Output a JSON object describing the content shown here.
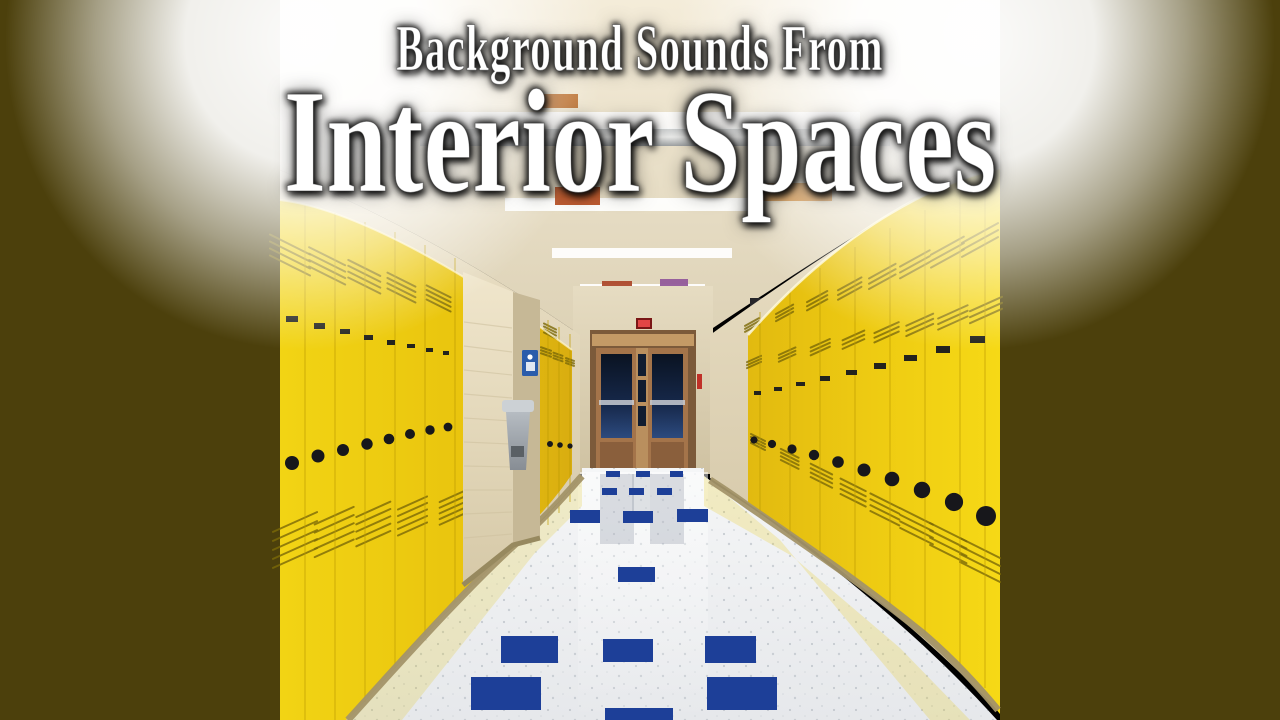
{
  "page": {
    "type": "album-art-thumbnail",
    "description": "School hallway with bright yellow lockers on both sides, cream block walls, white terrazzo floor with navy blue accent tiles, double doors with dark windows at the far end, fluorescent ceiling lights and posters on the ceiling. Dark olive pillarbox bars left and right. White serif title text with dark glow."
  },
  "titles": {
    "line1": "Background Sounds From",
    "line2": "Interior Spaces"
  },
  "colors": {
    "letterbox": "#4c400c",
    "locker_yellow": "#efc90e",
    "ceiling": "#eee6d0",
    "far_wall": "#d9cdae",
    "floor": "#eff1f3",
    "floor_tile": "#1d3f98",
    "door_frame": "#a4744a",
    "door_glass": "#16243e",
    "exit_sign": "#e24545",
    "restroom_sign": "#2a5cab",
    "trim": "#a39468",
    "text": "#ffffff"
  },
  "scene_items": {
    "ceiling_lights": {
      "type": "rect",
      "fill": "#ffffff",
      "opacity": 0.92,
      "items": [
        [
          140,
          112,
          440,
          17
        ],
        [
          225,
          198,
          255,
          13
        ],
        [
          272,
          248,
          180,
          10
        ],
        [
          300,
          284,
          125,
          8
        ],
        [
          318,
          306,
          88,
          6
        ]
      ]
    },
    "posters": {
      "type": "rect",
      "opacity": 0.95,
      "items": [
        [
          275,
          187,
          45,
          18,
          "#b85226"
        ],
        [
          478,
          183,
          74,
          18,
          "#c8812e"
        ],
        [
          322,
          281,
          30,
          12,
          "#ad4a2c"
        ],
        [
          380,
          279,
          28,
          13,
          "#925a9a"
        ],
        [
          256,
          94,
          42,
          14,
          "#b86a28"
        ]
      ]
    },
    "ceiling_fixtures": {
      "type": "rect",
      "fill": "#26262a",
      "items": [
        [
          470,
          298,
          26,
          14
        ],
        [
          350,
          308,
          10,
          9
        ]
      ]
    },
    "floor_tiles": {
      "type": "rect",
      "fill": "#1d3f98",
      "items": [
        [
          326,
          471,
          14,
          6
        ],
        [
          356,
          471,
          14,
          6
        ],
        [
          390,
          471,
          13,
          6
        ],
        [
          322,
          488,
          15,
          7
        ],
        [
          349,
          488,
          15,
          7
        ],
        [
          377,
          488,
          15,
          7
        ],
        [
          290,
          510,
          30,
          13
        ],
        [
          343,
          511,
          30,
          12
        ],
        [
          397,
          509,
          31,
          13
        ],
        [
          338,
          567,
          37,
          15
        ],
        [
          221,
          636,
          57,
          27
        ],
        [
          323,
          639,
          50,
          23
        ],
        [
          425,
          636,
          51,
          27
        ],
        [
          191,
          677,
          70,
          33
        ],
        [
          427,
          677,
          70,
          33
        ],
        [
          325,
          708,
          68,
          12
        ]
      ]
    },
    "locks_left": {
      "type": "circle",
      "fill": "#17171b",
      "items": [
        [
          12,
          463,
          7
        ],
        [
          38,
          456,
          6.5
        ],
        [
          63,
          450,
          6
        ],
        [
          87,
          444,
          5.7
        ],
        [
          109,
          439,
          5.3
        ],
        [
          130,
          434,
          5
        ],
        [
          150,
          430,
          4.7
        ],
        [
          168,
          427,
          4.4
        ],
        [
          270,
          444,
          3
        ],
        [
          280,
          445,
          2.8
        ],
        [
          290,
          446,
          2.6
        ]
      ]
    },
    "locks_right": {
      "type": "circle",
      "fill": "#17171b",
      "items": [
        [
          474,
          440,
          3.6
        ],
        [
          492,
          444,
          4.1
        ],
        [
          512,
          449,
          4.6
        ],
        [
          534,
          455,
          5.2
        ],
        [
          558,
          462,
          5.8
        ],
        [
          584,
          470,
          6.5
        ],
        [
          612,
          479,
          7.3
        ],
        [
          642,
          490,
          8.2
        ],
        [
          674,
          502,
          9.1
        ],
        [
          706,
          516,
          10
        ]
      ]
    },
    "handles_left": {
      "type": "rect",
      "fill": "#23231d",
      "items": [
        [
          6,
          316,
          12,
          6
        ],
        [
          34,
          323,
          11,
          6
        ],
        [
          60,
          329,
          10,
          5
        ],
        [
          84,
          335,
          9,
          5
        ],
        [
          107,
          340,
          8,
          5
        ],
        [
          127,
          344,
          8,
          4
        ],
        [
          146,
          348,
          7,
          4
        ],
        [
          163,
          351,
          6,
          4
        ]
      ]
    },
    "handles_right": {
      "type": "rect",
      "fill": "#23231d",
      "items": [
        [
          474,
          391,
          7,
          4
        ],
        [
          494,
          387,
          8,
          4
        ],
        [
          516,
          382,
          9,
          4
        ],
        [
          540,
          376,
          10,
          5
        ],
        [
          566,
          370,
          11,
          5
        ],
        [
          594,
          363,
          12,
          6
        ],
        [
          624,
          355,
          13,
          6
        ],
        [
          656,
          346,
          14,
          7
        ],
        [
          690,
          336,
          15,
          7
        ]
      ]
    },
    "seams_left": {
      "type": "line",
      "items": [
        [
          25,
          205,
          25,
          720
        ],
        [
          55,
          213,
          55,
          720
        ],
        [
          85,
          222,
          85,
          702
        ],
        [
          115,
          232,
          115,
          668
        ],
        [
          145,
          245,
          145,
          635
        ],
        [
          175,
          258,
          175,
          602
        ],
        [
          268,
          320,
          268,
          525
        ],
        [
          279,
          327,
          279,
          513
        ],
        [
          290,
          334,
          290,
          502
        ]
      ]
    },
    "seams_right": {
      "type": "line",
      "items": [
        [
          480,
          312,
          480,
          516
        ],
        [
          510,
          290,
          510,
          535
        ],
        [
          540,
          268,
          540,
          556
        ],
        [
          575,
          247,
          575,
          582
        ],
        [
          610,
          228,
          610,
          608
        ],
        [
          645,
          210,
          645,
          638
        ],
        [
          680,
          196,
          680,
          666
        ],
        [
          705,
          180,
          705,
          688
        ]
      ]
    },
    "pillar_lines": {
      "type": "line",
      "items": [
        [
          184,
          322,
          232,
          328
        ],
        [
          184,
          346,
          232,
          352
        ],
        [
          184,
          370,
          232,
          375
        ],
        [
          184,
          394,
          232,
          398
        ],
        [
          184,
          418,
          232,
          421
        ],
        [
          184,
          442,
          231,
          444
        ],
        [
          184,
          466,
          231,
          467
        ],
        [
          184,
          490,
          232,
          490
        ],
        [
          184,
          514,
          232,
          512
        ],
        [
          184,
          538,
          232,
          534
        ]
      ]
    }
  },
  "vent_bands": [
    {
      "g": "vents_left",
      "from": [
        10,
        255
      ],
      "to": [
        270,
        331
      ],
      "n": 8,
      "w0": 20,
      "w1": 6,
      "gap0": 7,
      "gap1": 3,
      "lines": 4,
      "tilt": 0.5
    },
    {
      "g": "vents_left",
      "from": [
        15,
        540
      ],
      "to": [
        250,
        492
      ],
      "n": 7,
      "w0": 22,
      "w1": 7,
      "gap0": 9,
      "gap1": 4,
      "lines": 5,
      "tilt": -0.45
    },
    {
      "g": "vents_left",
      "from": [
        266,
        352
      ],
      "to": [
        290,
        362
      ],
      "n": 3,
      "w0": 5,
      "w1": 4,
      "gap0": 3,
      "gap1": 2.5,
      "lines": 3,
      "tilt": 0.35
    },
    {
      "g": "vents_right",
      "from": [
        472,
        325
      ],
      "to": [
        700,
        240
      ],
      "n": 8,
      "w0": 7,
      "w1": 18,
      "gap0": 3,
      "gap1": 7,
      "lines": 3,
      "tilt": -0.55
    },
    {
      "g": "vents_right",
      "from": [
        474,
        362
      ],
      "to": [
        706,
        310
      ],
      "n": 8,
      "w0": 7,
      "w1": 16,
      "gap0": 3,
      "gap1": 6,
      "lines": 3,
      "tilt": -0.45
    },
    {
      "g": "vents_right",
      "from": [
        478,
        442
      ],
      "to": [
        700,
        560
      ],
      "n": 8,
      "w0": 7,
      "w1": 20,
      "gap0": 3,
      "gap1": 8,
      "lines": 4,
      "tilt": 0.5
    }
  ]
}
